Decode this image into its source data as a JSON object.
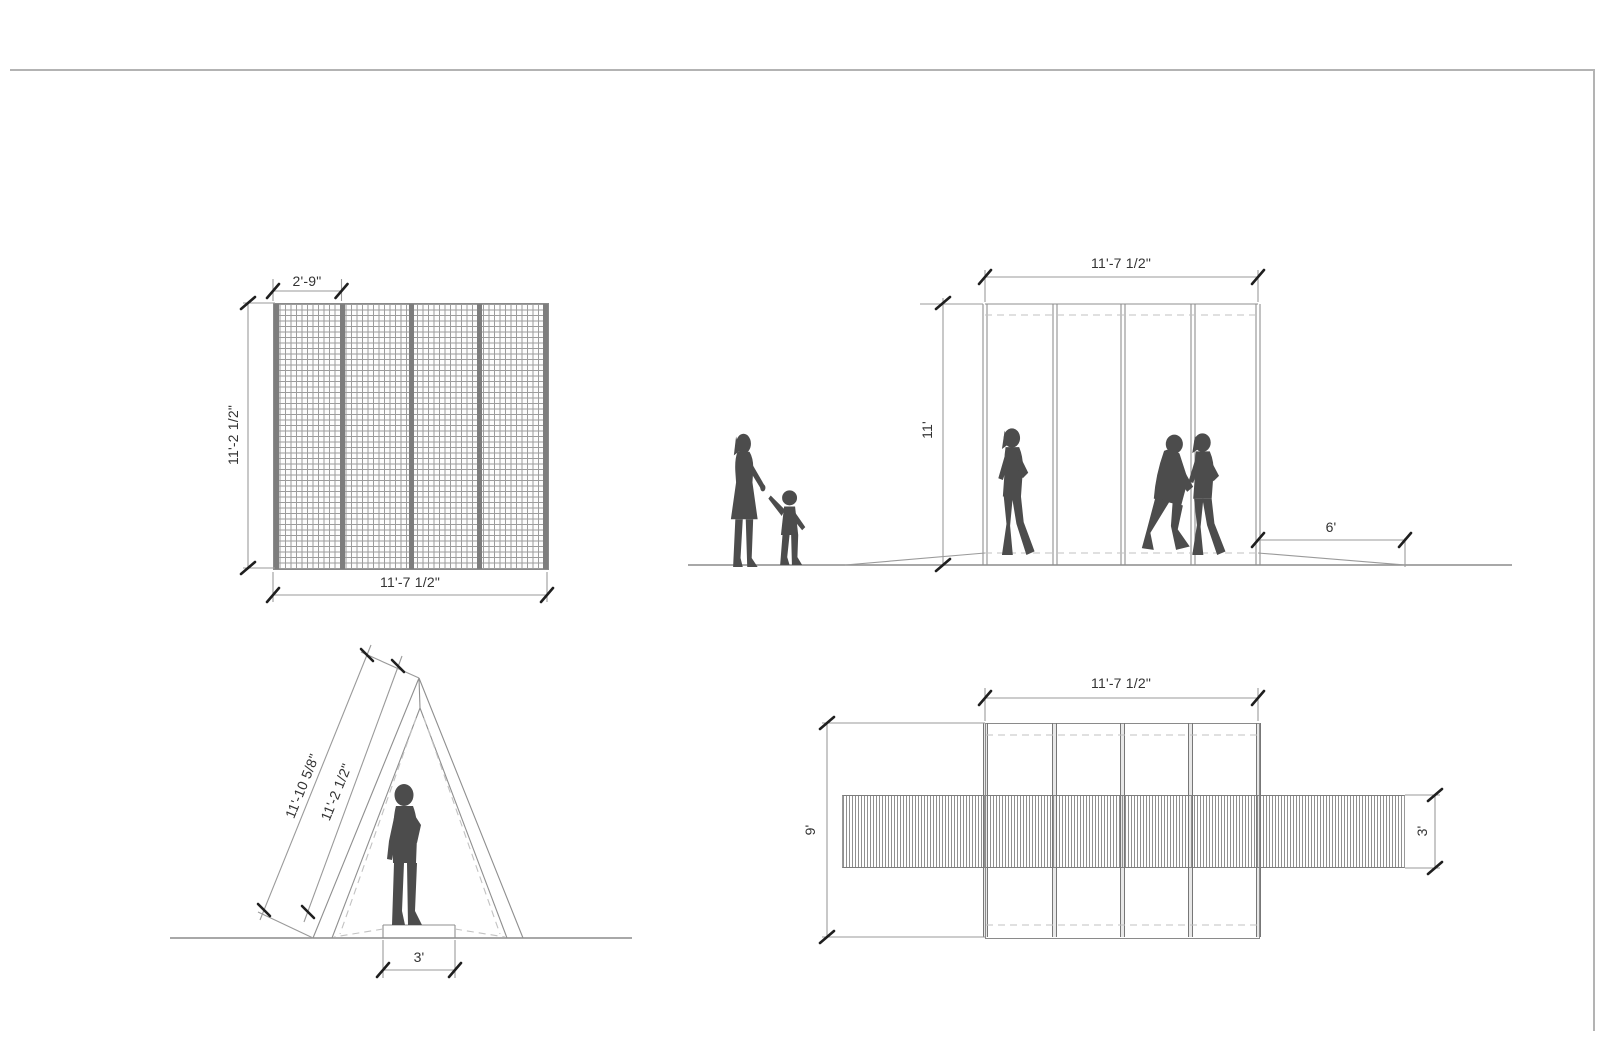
{
  "drawing": {
    "front_elevation": {
      "panel_width_label": "2'-9\"",
      "height_label": "11'-2 1/2\"",
      "width_label": "11'-7 1/2\""
    },
    "side_elevation": {
      "width_label": "11'-7 1/2\"",
      "height_label": "11'",
      "ramp_label": "6'"
    },
    "section": {
      "outer_slope_label": "11'-10 5/8\"",
      "inner_slope_label": "11'-2 1/2\"",
      "base_label": "3'"
    },
    "plan": {
      "width_label": "11'-7 1/2\"",
      "depth_label": "9'",
      "walkway_label": "3'"
    }
  },
  "colors": {
    "line": "#9a9a9a",
    "ground_line": "#8c8c8c",
    "tick": "#1f1f1f",
    "dash": "#c2c2c2",
    "silhouette": "#4c4c4c",
    "text": "#333333",
    "frame_border": "#b3b3b3",
    "mesh_line": "#9c9c9c",
    "mullion": "#7d7d7d",
    "hatch_line": "#909090"
  }
}
